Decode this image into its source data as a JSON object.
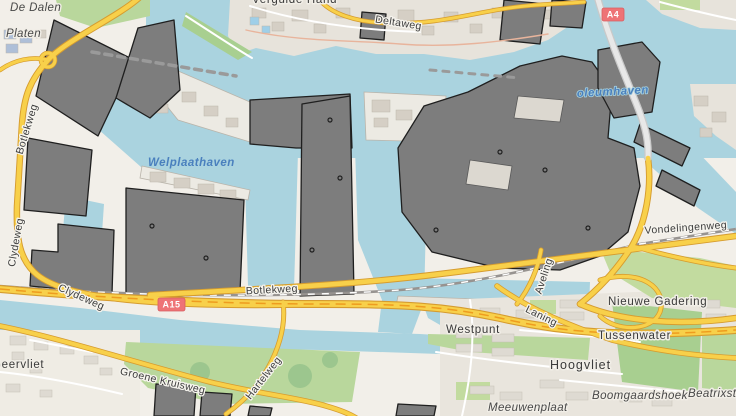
{
  "map": {
    "place_labels": {
      "de_dalen": "De Dalen",
      "platen": "Platen",
      "vergulde_hand": "Vergulde Hand",
      "geervliet": "Geervliet",
      "westpunt": "Westpunt",
      "hoogvliet": "Hoogvliet",
      "tussenwater": "Tussenwater",
      "nieuwe_gadering": "Nieuwe Gadering",
      "boomgaardshoek": "Boomgaardshoek",
      "beatrixst_clipped": "Beatrixst",
      "meeuwenplaat": "Meeuwenplaat"
    },
    "road_labels": {
      "deltaweg": "Deltaweg",
      "botlekweg_west": "Botlekweg",
      "clydeweg_vertical": "Clydeweg",
      "clydeweg": "Clydeweg",
      "botlekweg_center": "Botlekweg",
      "vondelingenweg": "Vondelingenweg",
      "aveling": "Aveling",
      "laning": "Laning",
      "groene_kruisweg": "Groene Kruisweg",
      "hartelweg": "Hartelweg"
    },
    "water_labels": {
      "welplaathaven": "Welplaathaven",
      "petroleumhaven_clipped": "oleumhaven"
    },
    "route_badges": {
      "a15": "A15",
      "a4": "A4"
    },
    "colors": {
      "water": "#aad3df",
      "land": "#f2efe9",
      "industrial_building": "#7d7d7d",
      "building_outline": "#1f1f1f",
      "urban_area": "#e7e3db",
      "small_building": "#d5cfc5",
      "green_area": "#b9d79c",
      "green_dark": "#9cc68e",
      "road_yellow_fill": "#f8d04a",
      "road_yellow_casing": "#d69c2f",
      "motorway_stripe": "#ee9c1f",
      "bridge_gray": "#c9c9c9",
      "railway": "#979390",
      "badge_red": "#ee7376",
      "road_label_color": "#3c3c3c",
      "water_label_color": "#4a80be"
    }
  }
}
